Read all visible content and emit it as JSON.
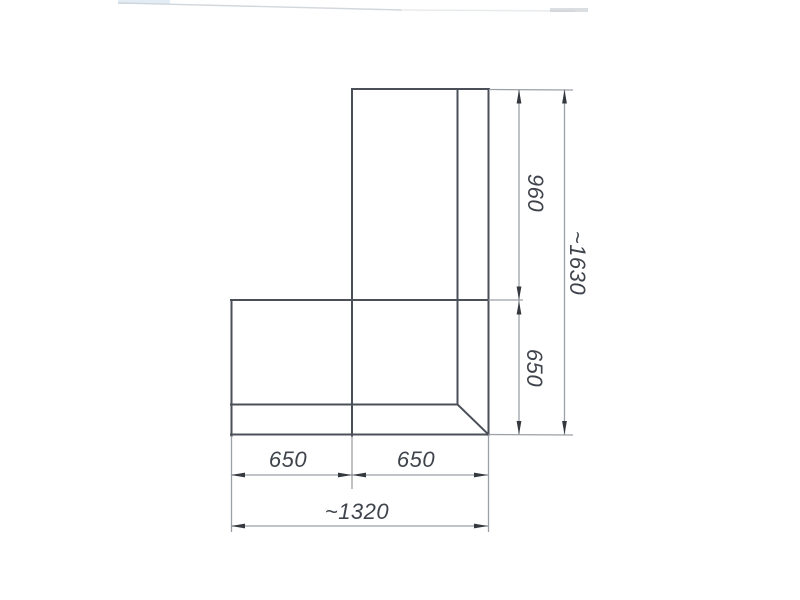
{
  "drawing": {
    "labels": {
      "dim_right_upper": "960",
      "dim_right_lower": "650",
      "dim_right_total": "~1630",
      "dim_bottom_left": "650",
      "dim_bottom_right": "650",
      "dim_bottom_total": "~1320"
    },
    "colors": {
      "outline": "#4a4f58",
      "dim_line": "#9ba0a6",
      "arrow": "#34383f",
      "text": "#3f444c",
      "background": "#ffffff"
    }
  }
}
